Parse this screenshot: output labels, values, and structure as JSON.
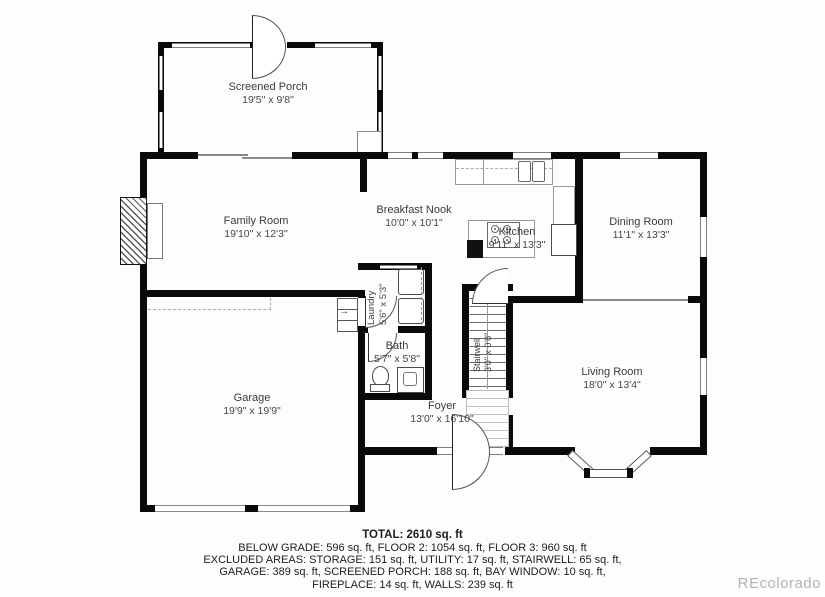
{
  "plan": {
    "rooms": {
      "screened_porch": {
        "name": "Screened Porch",
        "dims": "19'5\" x 9'8\""
      },
      "family": {
        "name": "Family Room",
        "dims": "19'10\" x 12'3\""
      },
      "breakfast": {
        "name": "Breakfast Nook",
        "dims": "10'0\" x 10'1\""
      },
      "kitchen": {
        "name": "Kitchen",
        "dims": "9'11\" x 13'3\""
      },
      "dining": {
        "name": "Dining Room",
        "dims": "11'1\" x 13'3\""
      },
      "laundry": {
        "name": "Laundry",
        "dims": "5'6\" x 5'3\""
      },
      "bath": {
        "name": "Bath",
        "dims": "5'7\" x 5'8\""
      },
      "stairwell": {
        "name": "Stairwell",
        "dims": "3'0\" x 0'8\""
      },
      "living": {
        "name": "Living Room",
        "dims": "18'0\" x 13'4\""
      },
      "garage": {
        "name": "Garage",
        "dims": "19'9\" x 19'9\""
      },
      "foyer": {
        "name": "Foyer",
        "dims": "13'0\" x 16'10\""
      }
    },
    "stair_arrow": "↑",
    "step_arrow": "→"
  },
  "summary": {
    "total": "TOTAL: 2610 sq. ft",
    "line1": "BELOW GRADE: 596 sq. ft, FLOOR 2: 1054 sq. ft, FLOOR 3: 960 sq. ft",
    "line2": "EXCLUDED AREAS: STORAGE: 151 sq. ft, UTILITY: 17 sq. ft, STAIRWELL: 65 sq. ft,",
    "line3": "GARAGE: 389 sq. ft, SCREENED PORCH: 188 sq. ft, BAY WINDOW: 10 sq. ft,",
    "line4": "FIREPLACE: 14 sq. ft, WALLS: 239 sq. ft"
  },
  "watermark": "REcolorado",
  "colors": {
    "wall": "#0a0a0a",
    "window_frame": "#7d7d7d",
    "label": "#3b3b3b",
    "watermark": "#b4b4b4"
  }
}
